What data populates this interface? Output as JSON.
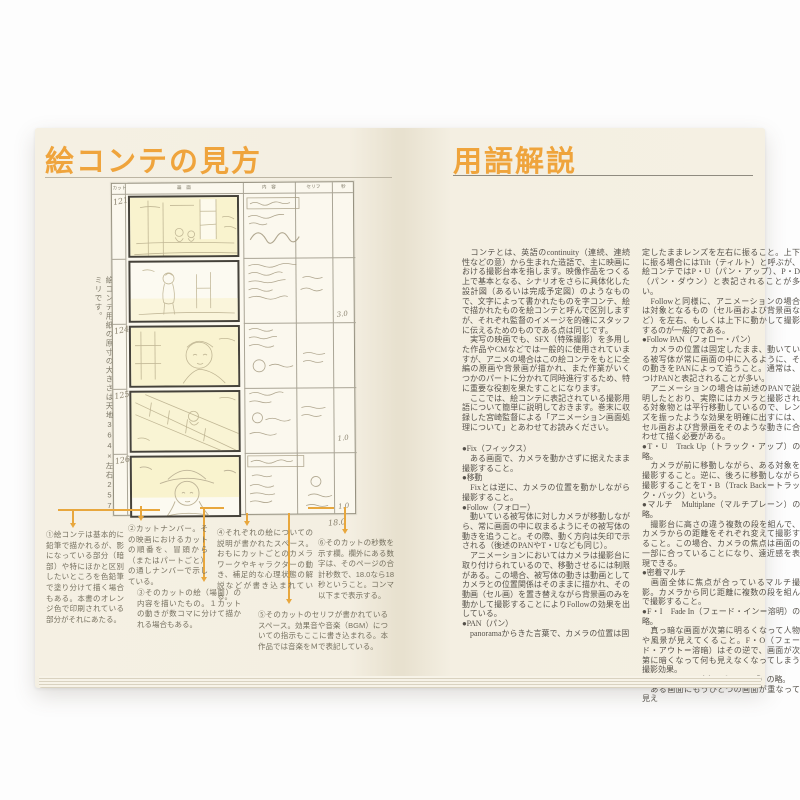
{
  "colors": {
    "accent_orange": "#EFA43C",
    "page_cream": "#F4EFE2",
    "text_dark": "#55514A"
  },
  "left_page": {
    "title": "絵コンテの見方",
    "vertical_caption": "絵コンテ用紙の原寸の大きさは天地364×左右257ミリです。",
    "storyboard": {
      "headers": {
        "cut": "カット",
        "picture": "画　面",
        "content": "内　容",
        "dialogue": "セリフ",
        "seconds": "秒"
      },
      "cut_numbers": [
        "121",
        "",
        "124",
        "125",
        "126"
      ],
      "seconds_values": [
        "",
        "",
        "3.0",
        "1.0",
        "1.0"
      ],
      "total_seconds": "18.0"
    },
    "annotations": [
      "①絵コンテは基本的に鉛筆で描かれるが、影になっている部分（暗部）や特にほかと区別したいところを色鉛筆で塗り分けて描く場合もある。本書のオレンジ色で印刷されている部分がそれにあたる。",
      "②カットナンバー。その映画におけるカットの順番を、冒頭から（またはパートごと）の通しナンバーで示している。",
      "③そのカットの絵（場面）の内容を描いたもの。１カットの動きが数コマに分けて描かれる場合もある。",
      "④それぞれの絵についての説明が書かれたスペース。おもにカットごとのカメラワークやキャラクターの動き、補足的な心理状態の解説などが書き込まれている。",
      "⑤そのカットのセリフが書かれているスペース。効果音や音楽（BGM）についての指示もここに書き込まれる。本作品では音楽をＭで表記している。",
      "⑥そのカットの秒数を示す欄。欄外にある数字は、そのページの合計秒数で、18.0なら18秒ということ。コンマ以下まで表示する。"
    ]
  },
  "right_page": {
    "title": "用語解説",
    "col1": [
      "　コンテとは、英語のcontinuity（連続、連続性などの意）から生まれた造語で、主に映画における撮影台本を指します。映像作品をつくる上で基本となる、シナリオをさらに具体化した設計図（あるいは完成予定図）のようなもので、文字によって書かれたものを字コンテ、絵で描かれたものを絵コンテと呼んで区別しますが、それぞれ監督のイメージを的確にスタッフに伝えるためのものである点は同じです。",
      "　実写の映画でも、SFX（特殊撮影）を多用した作品やCMなどでは一般的に使用されていますが、アニメの場合はこの絵コンテをもとに全編の原画や背景画が描かれ、また作業がいくつかのパートに分かれて同時進行するため、特に重要な役割を果たすことになります。",
      "　ここでは、絵コンテに表記されている撮影用語について簡単に説明しておきます。巻末に収録した宮崎監督による「アニメーション画面処理について」とあわせてお読みください。",
      "●Fix（フィックス）",
      "　ある画面で、カメラを動かさずに据えたまま撮影すること。",
      "●移動",
      "　Fixとは逆に、カメラの位置を動かしながら撮影すること。",
      "●Follow（フォロー）",
      "　動いている被写体に対しカメラが移動しながら、常に画面の中に収まるようにその被写体の動きを追うこと。その際、動く方向は矢印で示される（後述のPANやT・Uなども同じ）。",
      "　アニメーションにおいてはカメラは撮影台に取り付けられているので、移動させるには制限がある。この場合、被写体の動きは動画としてカメラとの位置関係はそのままに描かれ、その動画（セル画）を置き替えながら背景画のみを動かして撮影することによりFollowの効果を出している。",
      "●PAN（パン）",
      "　panoramaからきた言葉で、カメラの位置は固"
    ],
    "col2": [
      "定したままレンズを左右に振ること。上下に振る場合にはTilt（ティルト）と呼ぶが、絵コンテではP・U（パン・アップ）、P・D（パン・ダウン）と表記されることが多い。",
      "　Followと同様に、アニメーションの場合は対象となるもの（セル画および背景画など）を左右、もしくは上下に動かして撮影するのが一般的である。",
      "●Follow PAN（フォロー・パン）",
      "　カメラの位置は固定したまま、動いている被写体が常に画面の中に入るように、その動きをPANによって追うこと。通常は、つけPANと表記されることが多い。",
      "　アニメーションの場合は前述のPANで説明したとおり、実際にはカメラと撮影される対象物とは平行移動しているので、レンズを振ったような効果を明確に出すには、セル画および背景画をそのような動きに合わせて描く必要がある。",
      "●T・U　Track Up（トラック・アップ）の略。",
      "　カメラが前に移動しながら、ある対象を撮影すること。逆に、後ろに移動しながら撮影することをT・B（Track Back＝トラック・バック）という。",
      "●マルチ　Multiplane（マルチプレーン）の略。",
      "　撮影台に高さの違う複数の段を組んで、カメラからの距離をそれぞれ変えて撮影すること。この場合、カメラの焦点は画面の一部に合っていることになり、遠近感を表現できる。",
      "●密着マルチ",
      "　画面全体に焦点が合っているマルチ撮影。カメラから同じ距離に複数の段を組んで撮影すること。",
      "●F・I　Fade In（フェード・イン＝溶明）の略。",
      "　真っ暗な画面が次第に明るくなって人物や風景が見えてくること。F・O（フェード・アウト＝溶暗）はその逆で、画面が次第に暗くなって何も見えなくなってしまう撮影効果。",
      "●O・L　Overlap（オーバーラップ）の略。",
      "　ある画面にもうひとつの画面が重なって見え"
    ]
  }
}
